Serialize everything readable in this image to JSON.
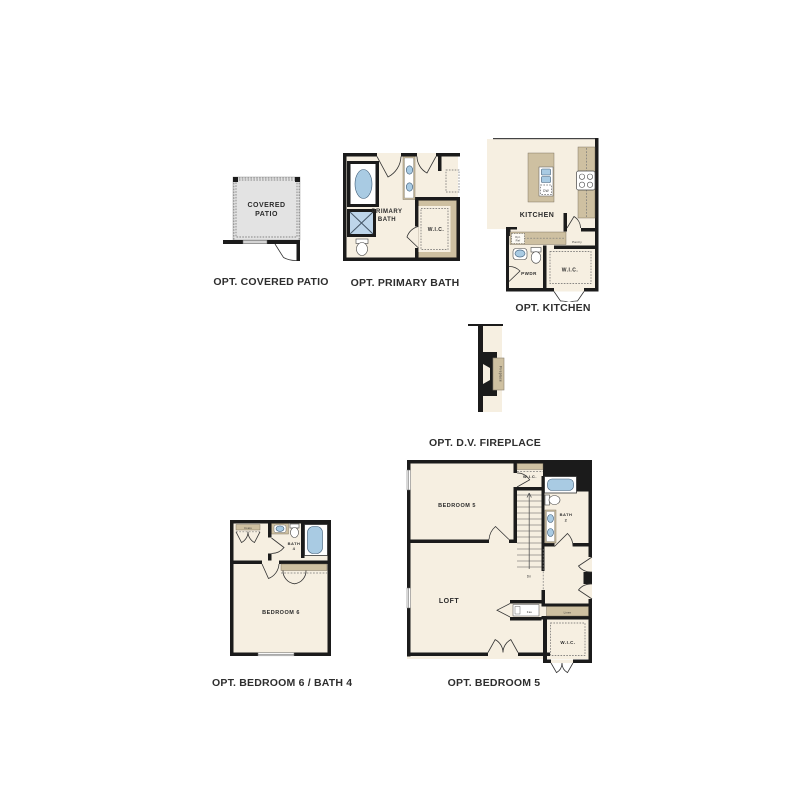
{
  "palette": {
    "wall": "#1b1b1b",
    "floor": "#f6efe1",
    "counter": "#cec0a1",
    "fixture": "#a9cbe3",
    "patio": "#e3e3e3",
    "caption_color": "#2e2e2e",
    "background": "#ffffff"
  },
  "plans": {
    "covered_patio": {
      "caption": "OPT. COVERED PATIO",
      "labels": {
        "room_line1": "COVERED",
        "room_line2": "PATIO"
      }
    },
    "primary_bath": {
      "caption": "OPT. PRIMARY BATH",
      "labels": {
        "room_line1": "PRIMARY",
        "room_line2": "BATH",
        "wic": "W.I.C."
      }
    },
    "kitchen": {
      "caption": "OPT. KITCHEN",
      "labels": {
        "room": "KITCHEN",
        "dw": "DW",
        "opt_ref_line1": "Opt.",
        "opt_ref_line2": "Ref",
        "pantry": "Pantry",
        "pwdr": "PWDR",
        "wic": "W.I.C."
      }
    },
    "fireplace": {
      "caption": "OPT. D.V. FIREPLACE",
      "labels": {
        "unit": "Fireplace"
      }
    },
    "bedroom6": {
      "caption": "OPT. BEDROOM 6 / BATH 4",
      "labels": {
        "coats": "Coats",
        "bath_line1": "BATH",
        "bath_line2": "4",
        "room": "BEDROOM 6"
      }
    },
    "bedroom5": {
      "caption": "OPT. BEDROOM 5",
      "labels": {
        "wic_top": "W.I.C.",
        "room": "BEDROOM 5",
        "bath_line1": "BATH",
        "bath_line2": "2",
        "dn": "Dn",
        "loft": "LOFT",
        "fau": "Fau",
        "linen": "Linen",
        "wic_bottom": "W.I.C."
      }
    }
  }
}
